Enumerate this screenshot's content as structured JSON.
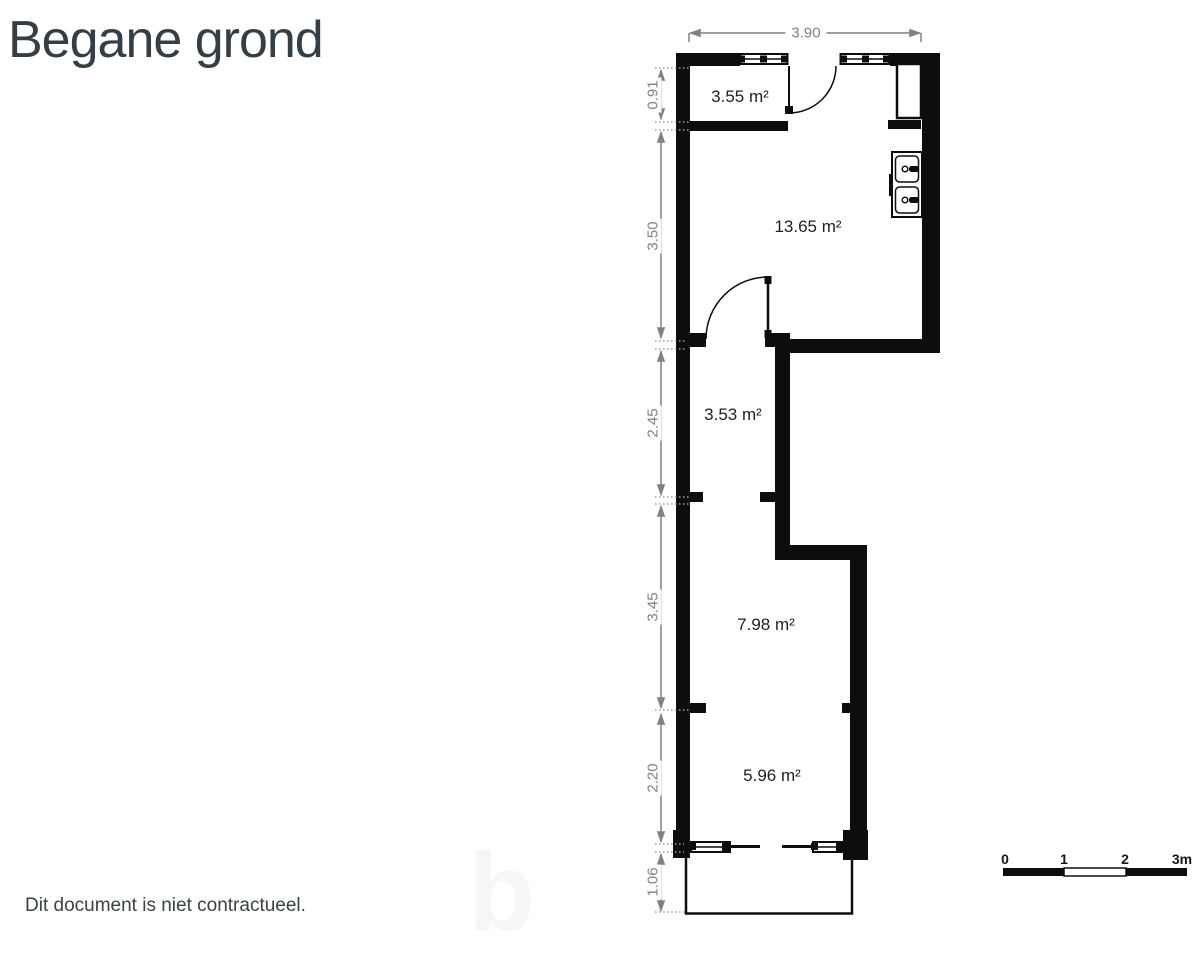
{
  "page": {
    "title": "Begane grond",
    "footer_note": "Dit document is niet contractueel.",
    "watermark_letter": "b"
  },
  "floor_plan": {
    "rooms": [
      {
        "label": "3.55 m²"
      },
      {
        "label": "13.65 m²"
      },
      {
        "label": "3.53 m²"
      },
      {
        "label": "7.98 m²"
      },
      {
        "label": "5.96 m²"
      }
    ],
    "dimensions": {
      "top": "3.90",
      "left": [
        "0.91",
        "3.50",
        "2.45",
        "3.45",
        "2.20",
        "1.06"
      ]
    },
    "fixtures": [
      "entry-door",
      "interior-door",
      "window",
      "window",
      "window",
      "window",
      "closet",
      "double-sink",
      "porch"
    ]
  },
  "scale_bar": {
    "labels": [
      "0",
      "1",
      "2",
      "3m"
    ]
  },
  "colors": {
    "wall": "#0d0d0d",
    "dimension_gray": "#7d8286",
    "title_color": "#343e44"
  }
}
